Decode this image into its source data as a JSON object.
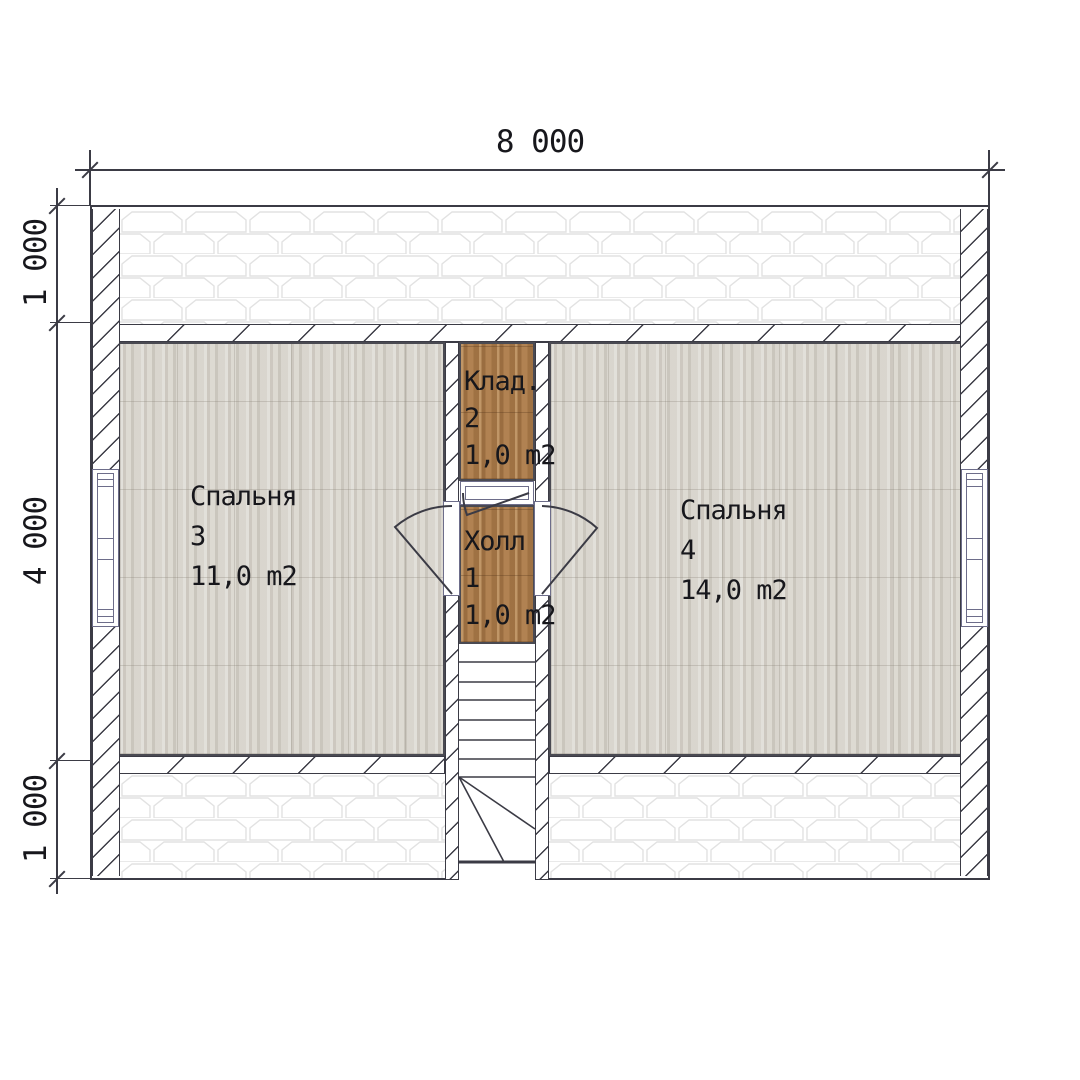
{
  "dimensions": {
    "top_width": "8 000",
    "left_upper": "1 000",
    "left_middle": "4 000",
    "left_lower": "1 000"
  },
  "rooms": {
    "bedroom3": {
      "name": "Спальня",
      "number": "3",
      "area": "11,0 m2"
    },
    "closet": {
      "name": "Клад.",
      "number": "2",
      "area": "1,0 m2"
    },
    "hall": {
      "name": "Холл",
      "number": "1",
      "area": "1,0 m2"
    },
    "bedroom4": {
      "name": "Спальня",
      "number": "4",
      "area": "14,0 m2"
    }
  },
  "colors": {
    "line": "#3b3b45",
    "frame": "#6d6d8a",
    "wood_light_base": "#d6d2ca",
    "wood_brown_base": "#a87a4a",
    "shingle_line": "#e2e2e2",
    "text": "#17171c"
  }
}
